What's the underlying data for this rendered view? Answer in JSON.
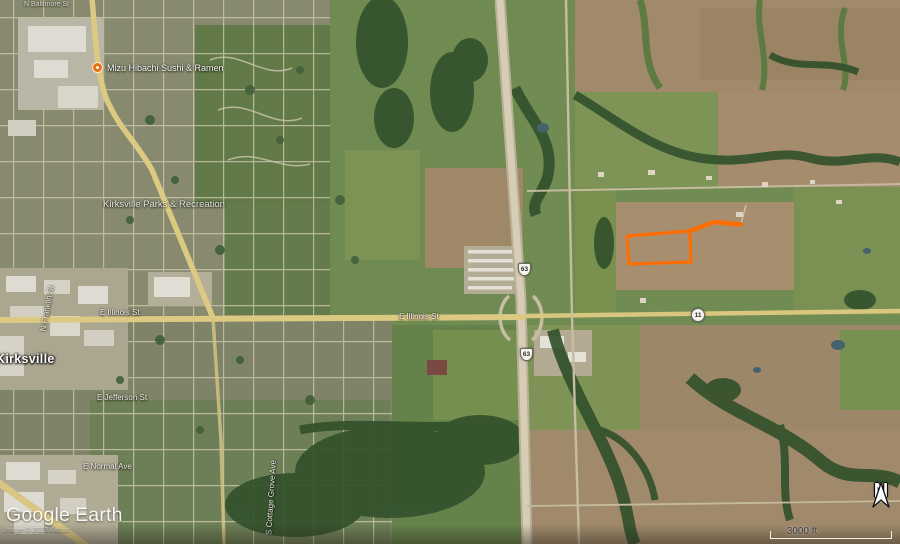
{
  "overlay": {
    "logo": {
      "google": "Google",
      "earth": "Earth"
    },
    "attribution": "Image © 2023 Airbus",
    "scale_label": "3000 ft",
    "north_label": "N"
  },
  "map": {
    "city_label": "Kirksville",
    "poi_label": "Mizu Hibachi Sushi & Ramen",
    "park_label": "Kirksville Parks & Recreation",
    "streets": {
      "e_illinois_w": "E Illinois St",
      "e_illinois_c": "E Illinois St",
      "e_jefferson": "E Jefferson St",
      "e_normal": "E Normal Ave",
      "s_cottage_grove": "S Cottage Grove Ave",
      "n_franklin": "N Franklin St",
      "n_baltimore": "N Baltimore St"
    },
    "shields": {
      "us63": "63",
      "mo11": "11"
    }
  },
  "colors": {
    "parcel_outline": "#FF6D00",
    "poi_dot": "#E8710A",
    "road_primary": "#DDCA82",
    "highway_surface": "#D6CDB4"
  }
}
